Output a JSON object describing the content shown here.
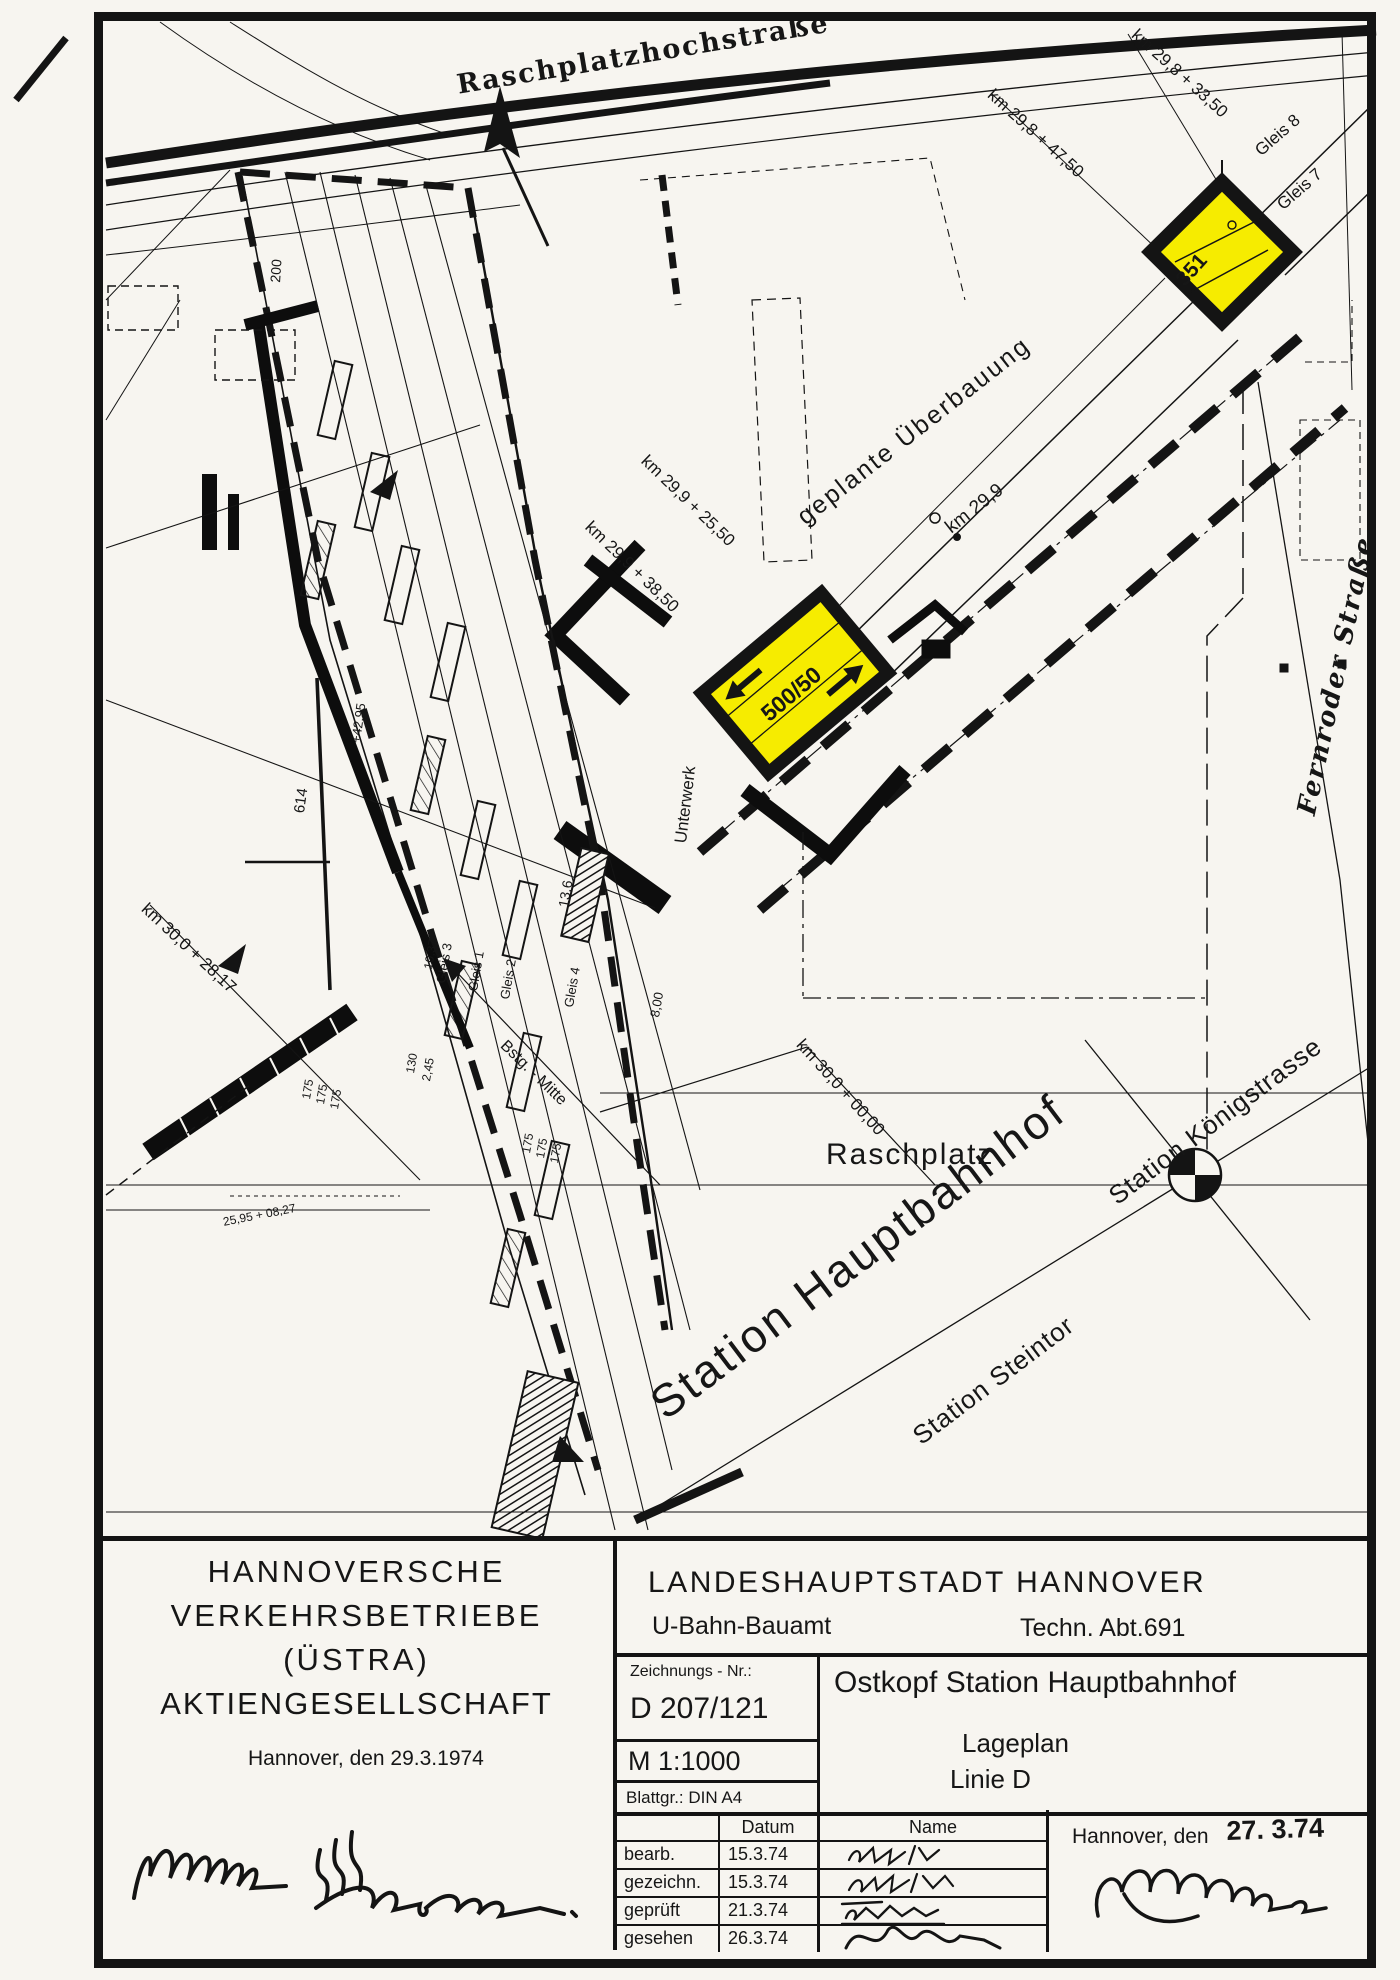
{
  "map": {
    "streets": {
      "top": "Raschplatzhochstraße",
      "right": "Fernroder Straße",
      "square": "Raschplatz"
    },
    "stations": {
      "main": "Station Hauptbahnhof",
      "steintor": "Station Steintor",
      "koenigstrasse": "Station Königstrasse"
    },
    "notes": {
      "overbuild": "geplante Überbauung",
      "substation": "Unterwerk",
      "platform_mid": "Bstg. - Mitte",
      "box_center": "500/50",
      "box_ne": "351"
    },
    "chainage": {
      "c1": "km 29,8 + 33,50",
      "c2": "km 29,8 + 47,50",
      "c3": "km 29,9 + 25,50",
      "c4": "km 29,9 + 38,50",
      "c5": "km 29,9",
      "c6": "km 30,0 + 28,17",
      "c7": "km 30,0 + 00,00"
    },
    "tracks": {
      "g1": "Gleis 1",
      "g2": "Gleis 2",
      "g3": "Gleis 3",
      "g4": "Gleis 4",
      "g7": "Gleis 7",
      "g8": "Gleis 8"
    },
    "dimensions": {
      "d1": "614",
      "d2": "+42,95",
      "d3": "200",
      "d4": "175",
      "d5": "130",
      "d6": "2,45",
      "d7": "13,6",
      "d8": "10,37",
      "d9": "8,00",
      "d10": "25,95 + 08,27"
    }
  },
  "titleblock": {
    "company": {
      "line1": "HANNOVERSCHE",
      "line2": "VERKEHRSBETRIEBE",
      "line3": "(ÜSTRA)",
      "line4": "AKTIENGESELLSCHAFT",
      "date": "Hannover, den 29.3.1974"
    },
    "authority": {
      "name": "LANDESHAUPTSTADT  HANNOVER",
      "office": "U-Bahn-Bauamt",
      "dept": "Techn. Abt.691"
    },
    "drawing": {
      "number_label": "Zeichnungs - Nr.:",
      "number": "D 207/121",
      "scale": "M 1:1000",
      "sheet": "Blattgr.: DIN A4"
    },
    "title": {
      "line1": "Ostkopf Station Hauptbahnhof",
      "line2": "Lageplan",
      "line3": "Linie D"
    },
    "approval": {
      "col_date": "Datum",
      "col_name": "Name",
      "rows": [
        {
          "label": "bearb.",
          "date": "15.3.74"
        },
        {
          "label": "gezeichn.",
          "date": "15.3.74"
        },
        {
          "label": "geprüft",
          "date": "21.3.74"
        },
        {
          "label": "gesehen",
          "date": "26.3.74"
        }
      ]
    },
    "sign": {
      "place": "Hannover, den",
      "date": "27. 3.74"
    }
  },
  "colors": {
    "highlight": "#f6ec00",
    "ink": "#161616",
    "paper": "#f7f5f0"
  }
}
